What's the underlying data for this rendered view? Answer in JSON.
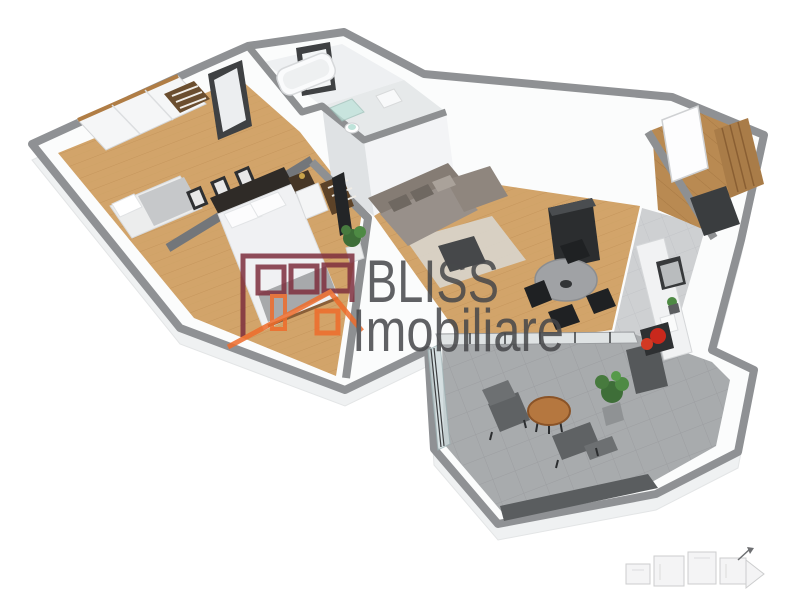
{
  "watermark": {
    "line1": "BLISS",
    "line2": "Imobiliare",
    "text_color": "#46474a",
    "logo_building_color": "#7e2f3e",
    "logo_house_color": "#ef6c2b"
  },
  "scene": {
    "render_type": "3D isometric apartment floor-plan render",
    "background": "#ffffff",
    "palette": {
      "wall_top_gray": "#8f9194",
      "wall_face_white": "#f4f5f6",
      "wood_floor": "#d2a46a",
      "entry_wood": "#b98a52",
      "balcony_tile": "#a8abad",
      "kitchen_tile": "#ced0d2",
      "sofa_gray": "#98908a",
      "furniture_dark": "#2b2d2f",
      "accent_red": "#c9281c",
      "plant_green": "#477a3e",
      "shower_glass_teal": "#bfe3da"
    },
    "rooms": [
      "bedroom-small",
      "bedroom-master",
      "bathroom",
      "shower-wc",
      "hallway",
      "living-room",
      "kitchen-dining",
      "entry-hall",
      "balcony-terrace"
    ]
  },
  "minimap": {
    "type": "faint site-plan sketch",
    "arrow": "north-east"
  }
}
